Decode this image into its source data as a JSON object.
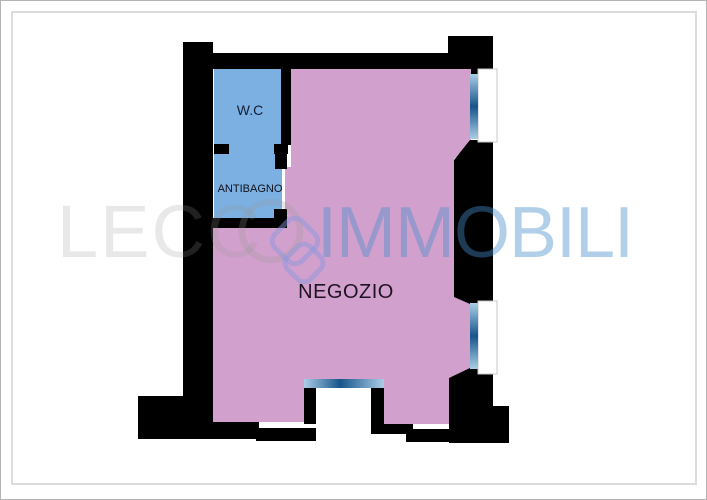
{
  "page": {
    "background": "#ffffff",
    "outer_border_color": "#b3b3b3",
    "inner_border_color": "#dcdcdc"
  },
  "plan": {
    "wall_color": "#000000",
    "rooms": [
      {
        "id": "negozio",
        "label": "NEGOZIO",
        "fill": "#d2a0cd",
        "label_color": "#1e1322"
      },
      {
        "id": "wc",
        "label": "W.C",
        "fill": "#7cb0e3",
        "label_color": "#141e33"
      },
      {
        "id": "antibagno",
        "label": "ANTIBAGNO",
        "fill": "#7cb0e3",
        "label_color": "#10101a"
      }
    ],
    "window_fill": "#ffffff",
    "window_frame_color": "#c9c9c9",
    "glass_gradient_edge": "#aacde7",
    "glass_gradient_center": "#17558a",
    "features": [
      "window-right-upper",
      "window-right-lower",
      "entrance-bottom-center",
      "door-wc-antibagno",
      "door-antibagno-negozio"
    ]
  },
  "watermark": {
    "text_left": "LECC",
    "text_right": "IMMOBILI",
    "left_color": "rgba(150,150,150,0.22)",
    "right_color": "rgba(70,140,200,0.42)",
    "ring_color": "rgba(150,150,150,0.25)",
    "pin_color": "rgba(135,150,225,0.45)"
  }
}
